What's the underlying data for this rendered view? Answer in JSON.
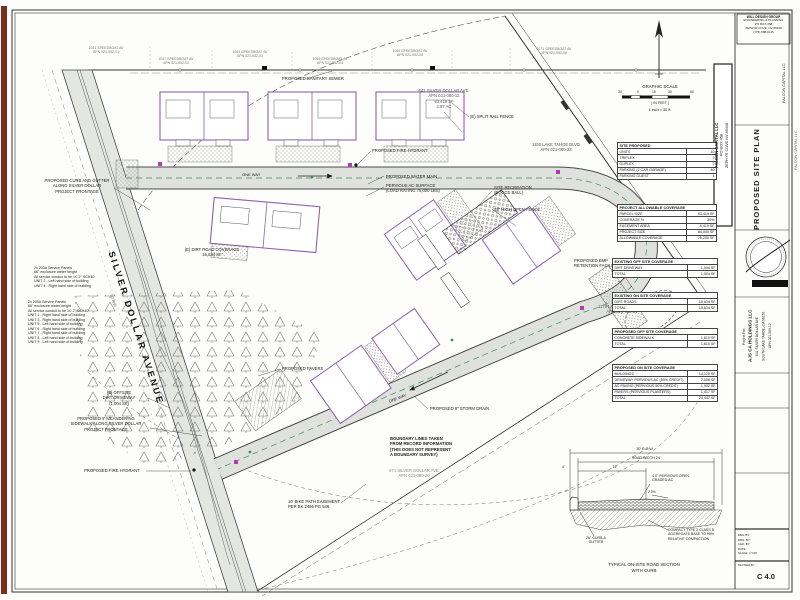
{
  "title_block": {
    "engineer_box_lines": [
      "WILL DESIGN GROUP",
      "ENGINEERING & PLANNING",
      "PO BOX 458",
      "ZEPHYR COVE, NV 89448",
      "(775) 588-0115"
    ],
    "client_box_lines": [
      "FALCON CAPITAL LLC",
      "PO BOX 458",
      "ZEPHYR COVE NV 89448"
    ],
    "side_label_1": "FALCON CAPITAL LLC",
    "side_label_2": "FALCON CAPITAL LLC",
    "sheet_title": "PROPOSED SITE PLAN",
    "project_for_lines": [
      "Project For:",
      "AJS CA HOLDINGS LLC",
      "641 SILVER DOLLAR AVE",
      "SOUTH LAKE TAHOE, CA 96150",
      "APN 021-080-12"
    ],
    "info_lines": [
      "DES. BY:",
      "DRN. BY:",
      "CHK. BY:",
      "DATE:",
      "SCALE: 1\"=30'"
    ],
    "revised_label": "REVISED BY",
    "sheet_number": "C 4.0"
  },
  "north_scale": {
    "title": "GRAPHIC SCALE",
    "in_feet": "( IN FEET )",
    "note": "1 inch = 30 ft.",
    "ticks": [
      {
        "t": "30",
        "x": 618
      },
      {
        "t": "0",
        "x": 637
      },
      {
        "t": "15",
        "x": 652
      },
      {
        "t": "30",
        "x": 668
      },
      {
        "t": "60",
        "x": 690
      }
    ]
  },
  "site_tables": [
    {
      "title": "SITE PROPOSED",
      "rows": [
        [
          "UNITS",
          "10"
        ],
        [
          "TRIPLEX",
          "2"
        ],
        [
          "DUPLEX",
          "2"
        ],
        [
          "PARKING (2 CAR GARAGE)",
          "40"
        ],
        [
          "PARKING GUEST",
          "4"
        ]
      ]
    },
    {
      "title": "PROJECT ALLOWABLE COVERAGE",
      "rows": [
        [
          "PARCEL SIZE",
          "93,419 SF"
        ],
        [
          "COVERAGE %",
          "30%"
        ],
        [
          "EASEMENT AREA",
          "-9,419 SF"
        ],
        [
          "PROJECT SIZE",
          "84,000 SF"
        ],
        [
          "ALLOWABLE COVERAGE",
          "25,200 SF"
        ]
      ]
    },
    {
      "title": "EXISTING OFF SITE COVERAGE",
      "rows": [
        [
          "DIRT DRIVEWAY",
          "1,004 SF"
        ],
        [
          "TOTAL",
          "1,004 SF"
        ]
      ]
    },
    {
      "title": "EXISTING ON SITE COVERAGE",
      "rows": [
        [
          "DIRT ROADS",
          "15,634 SF"
        ],
        [
          "TOTAL",
          "15,634 SF"
        ]
      ]
    },
    {
      "title": "PROPOSED OFF SITE COVERAGE",
      "rows": [
        [
          "CONCRETE SIDEWALK",
          "1,810 SF"
        ],
        [
          "TOTAL",
          "1,810 SF"
        ]
      ]
    },
    {
      "title": "PROPOSED ON SITE COVERAGE",
      "rows": [
        [
          "BUILDINGS",
          "14,120 SF"
        ],
        [
          "DRIVEWAY PERVIOUS AC (50% CREDIT)",
          "7,008 SF"
        ],
        [
          "AC PAVING (PERVIOUS 50% CREDIT)",
          "1,902 SF"
        ],
        [
          "PAVERS (PERVIOUS PLANTERS)",
          "1,417 SF"
        ],
        [
          "TOTAL",
          "24,447 SF"
        ]
      ]
    }
  ],
  "plan_labels": [
    {
      "name": "street-label-silver-dollar",
      "text": "SILVER DOLLAR AVENUE",
      "x": 116,
      "y": 250,
      "rotate": 72,
      "size": 9,
      "bold": true,
      "ls": 2.5,
      "color": "#111"
    },
    {
      "name": "one-way-top-label",
      "text": "ONE WAY",
      "x": 242,
      "y": 172,
      "size": 4
    },
    {
      "name": "one-way-diag-label",
      "text": "ONE WAY",
      "x": 388,
      "y": 399,
      "rotate": -21,
      "size": 4
    },
    {
      "name": "curb-gutter-note",
      "text": "PROPOSED CURB AND GUTTER\nALONG SILVER DOLLAR\nPROJECT FRONTAGE",
      "x": 40,
      "y": 178,
      "w": 74,
      "align": "center"
    },
    {
      "name": "sanitary-sewer-label",
      "text": "PROPOSED SANITARY SEWER",
      "x": 282,
      "y": 76
    },
    {
      "name": "parcel-info-label",
      "text": "641 SILVER DOLLAR AVE.\nAPN 021-080-12\n93,419 SF\n2.97 AC",
      "x": 402,
      "y": 88,
      "w": 84,
      "align": "center",
      "color": "#555"
    },
    {
      "name": "split-rail-fence-label",
      "text": "(E) SPLIT RAIL FENCE",
      "x": 470,
      "y": 114
    },
    {
      "name": "lake-tahoe-parcel-1",
      "text": "1150 LAKE TAHOE BLVD\nAPN 021-080-33",
      "x": 520,
      "y": 142,
      "w": 72,
      "align": "center",
      "color": "#555"
    },
    {
      "name": "fire-hydrant-label-1",
      "text": "PROPOSED FIRE HYDRANT",
      "x": 372,
      "y": 148
    },
    {
      "name": "water-main-label",
      "text": "PROPOSED WATER MAIN",
      "x": 386,
      "y": 174
    },
    {
      "name": "pervious-ac-label",
      "text": "PERVIOUS AC SURFACE\n(LOAD RATING 75,000 LBS)",
      "x": 386,
      "y": 183
    },
    {
      "name": "bocce-label",
      "text": "SITE RECREATION\n(BOCCE BALL)",
      "x": 494,
      "y": 185
    },
    {
      "name": "open-fence-label",
      "text": "48\" HIGH OPEN FENCE",
      "x": 494,
      "y": 207
    },
    {
      "name": "bmp-label",
      "text": "PROPOSED BMP\nRETENTION FACILITY",
      "x": 574,
      "y": 258
    },
    {
      "name": "lake-tahoe-parcel-2",
      "text": "1170 LAKE TAHOE BLVD\nAPN 021-080-34",
      "x": 586,
      "y": 304,
      "w": 72,
      "align": "center",
      "color": "#555"
    },
    {
      "name": "pavers-label",
      "text": "PROPOSED PAVERS",
      "x": 282,
      "y": 366
    },
    {
      "name": "storm-drain-label",
      "text": "PROPOSED 8\" STORM DRAIN",
      "x": 430,
      "y": 406
    },
    {
      "name": "boundary-note",
      "text": "BOUNDARY LINES TAKEN\nFROM RECORD INFORMATION\n(THIS DOES NOT REPRESENT\nA BOUNDARY SURVEY)",
      "x": 390,
      "y": 436,
      "bold": true
    },
    {
      "name": "parcel-south-label",
      "text": "671 SILVER DOLLAR AVE\nAPN 021-080-20",
      "x": 378,
      "y": 468,
      "w": 72,
      "align": "center",
      "color": "#888"
    },
    {
      "name": "bike-path-label",
      "text": "10' BIKE PATH EASEMENT\nPER BK 2486 PG 546",
      "x": 288,
      "y": 499
    },
    {
      "name": "fire-hydrant-label-2",
      "text": "PROPOSED FIRE HYDRANT",
      "x": 84,
      "y": 468
    },
    {
      "name": "sidewalk-note",
      "text": "PROPOSED 5' MEANDERING\nSIDEWALK ALONG SILVER DOLLAR\nPROJECT FRONTAGE",
      "x": 62,
      "y": 416,
      "w": 88,
      "align": "center"
    },
    {
      "name": "dirt-driveway-label",
      "text": "(E) OFFSITE\nDIRT DRIVEWAY\n(1,004 SF)",
      "x": 90,
      "y": 390,
      "w": 58,
      "align": "center"
    },
    {
      "name": "service-panel-note-a",
      "text": "2x 200A Service Panels\n66\" enclosure meter height\nAll service conduit to be 1C 2\" SCH40\nUNIT 2 - Left hand side of building\nUNIT 4 - Right hand side of building",
      "x": 34,
      "y": 266,
      "size": 3.6
    },
    {
      "name": "service-panel-note-b",
      "text": "2x 200A Service Panels\n66\" enclosure meter height\nAll service conduit to be 1C 2\" SCH40\nUNIT 1 - Right hand side of building\nUNIT 3 - Right hand side of building\nUNIT 5 - Left hand side of building\nUNIT 6 - Right hand side of building\nUNIT 7 - Right hand side of building\nUNIT 8 - Left hand side of building\nUNIT 9 - Left hand side of building",
      "x": 28,
      "y": 300,
      "size": 3.6
    },
    {
      "name": "dirt-road-coverage-label",
      "text": "(E) DIRT ROAD COVERAGE\n15,634 SF",
      "x": 176,
      "y": 247,
      "w": 72,
      "align": "center"
    },
    {
      "name": "rw-label-1",
      "text": "50' R/W",
      "x": 113,
      "y": 294,
      "rotate": 72,
      "size": 3.6,
      "color": "#555"
    },
    {
      "name": "adjacent-parcel-note",
      "text": "1041 SPEEDBOAT AV\nAPN 021-052-01",
      "x": 72,
      "y": 46,
      "w": 68,
      "align": "center",
      "color": "#777",
      "size": 3.5
    },
    {
      "name": "adjacent-parcel-note",
      "text": "1047 SPEEDBOAT AV\nAPN 021-052-02",
      "x": 142,
      "y": 57,
      "w": 68,
      "align": "center",
      "color": "#777",
      "size": 3.5
    },
    {
      "name": "adjacent-parcel-note",
      "text": "1053 SPEEDBOAT AV\nAPN 021-052-03",
      "x": 216,
      "y": 50,
      "w": 68,
      "align": "center",
      "color": "#777",
      "size": 3.5
    },
    {
      "name": "adjacent-parcel-note",
      "text": "1059 SPEEDBOAT AV\nAPN 021-052-04",
      "x": 296,
      "y": 57,
      "w": 68,
      "align": "center",
      "color": "#777",
      "size": 3.5
    },
    {
      "name": "adjacent-parcel-note",
      "text": "1065 SPEEDBOAT AV\nAPN 021-052-05",
      "x": 376,
      "y": 49,
      "w": 68,
      "align": "center",
      "color": "#777",
      "size": 3.5
    },
    {
      "name": "adjacent-parcel-note",
      "text": "1071 SPEEDBOAT AV\nAPN 021-052-06",
      "x": 520,
      "y": 47,
      "w": 68,
      "align": "center",
      "color": "#777",
      "size": 3.5
    }
  ],
  "detail": {
    "row_dim": "30' R.O.W.",
    "road_dim": "ROAD WIDTH 24'",
    "half_dim": "12'",
    "curb_dim": "4'",
    "surface_note": "4.0\" PERVIOUS OPEN\nGRADED AC",
    "slope_note": "2.0%",
    "base_note": "COMPACT TYPE 2 CLASS B\nAGGREGATE BASE TO 95%\nRELATIVE COMPACTION",
    "curb_note": "26\" CURB &\nGUTTER",
    "title": "TYPICAL ON-SITE ROAD SECTION\nWITH CURB"
  },
  "colors": {
    "line": "#2b2b2b",
    "road_fill": "#dfe2dc",
    "building_outline": "#8a63b0",
    "utility_magenta": "#b43ab4",
    "centerline_green": "#3f8f4f",
    "edge_bar_maroon": "#7d2d1f"
  }
}
